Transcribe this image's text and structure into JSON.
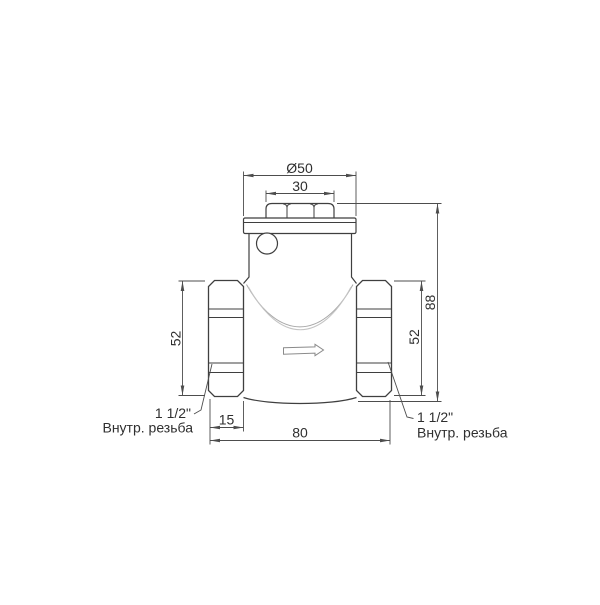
{
  "drawing": {
    "type": "technical-drawing",
    "subject": "swing check valve side view with dimensions",
    "dimensions": {
      "flange_diameter": "Ø50",
      "cap_width": "30",
      "left_union_height": "52",
      "right_union_height": "52",
      "overall_height": "88",
      "union_nut_length": "15",
      "overall_length": "80"
    },
    "labels": {
      "left_thread_size": "1 1/2\"",
      "left_thread_note": "Внутр. резьба",
      "right_thread_size": "1 1/2\"",
      "right_thread_note": "Внутр. резьба"
    },
    "colors": {
      "outline": "#3f3f3f",
      "dimension_line": "#4d4d4d",
      "light_detail": "#a8a8a8",
      "text": "#2f2f2f",
      "background": "#ffffff"
    }
  }
}
